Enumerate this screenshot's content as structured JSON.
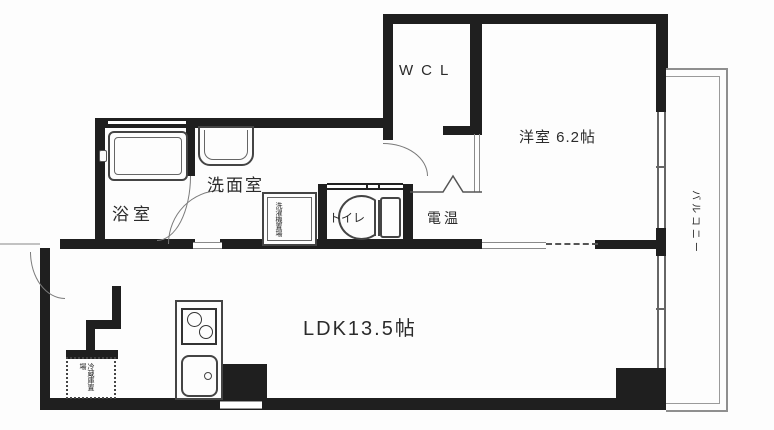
{
  "rooms": {
    "wcl": {
      "label": "WCL"
    },
    "western_room": {
      "label": "洋室 6.2帖"
    },
    "bathroom": {
      "label": "浴室"
    },
    "washroom": {
      "label": "洗面室"
    },
    "toilet": {
      "label": "トイレ"
    },
    "water_heater": {
      "label": "電温"
    },
    "ldk": {
      "label": "LDK13.5帖"
    },
    "balcony": {
      "label": "バルコニー"
    }
  },
  "fixtures": {
    "laundry_space": {
      "label": "洗濯機置場"
    },
    "fridge_space": {
      "label": "冷蔵庫置場"
    }
  },
  "colors": {
    "wall": "#1f1f1f",
    "thin_line": "#8a8a8a",
    "background": "#fdfdfd",
    "text": "#2b2b2b"
  }
}
